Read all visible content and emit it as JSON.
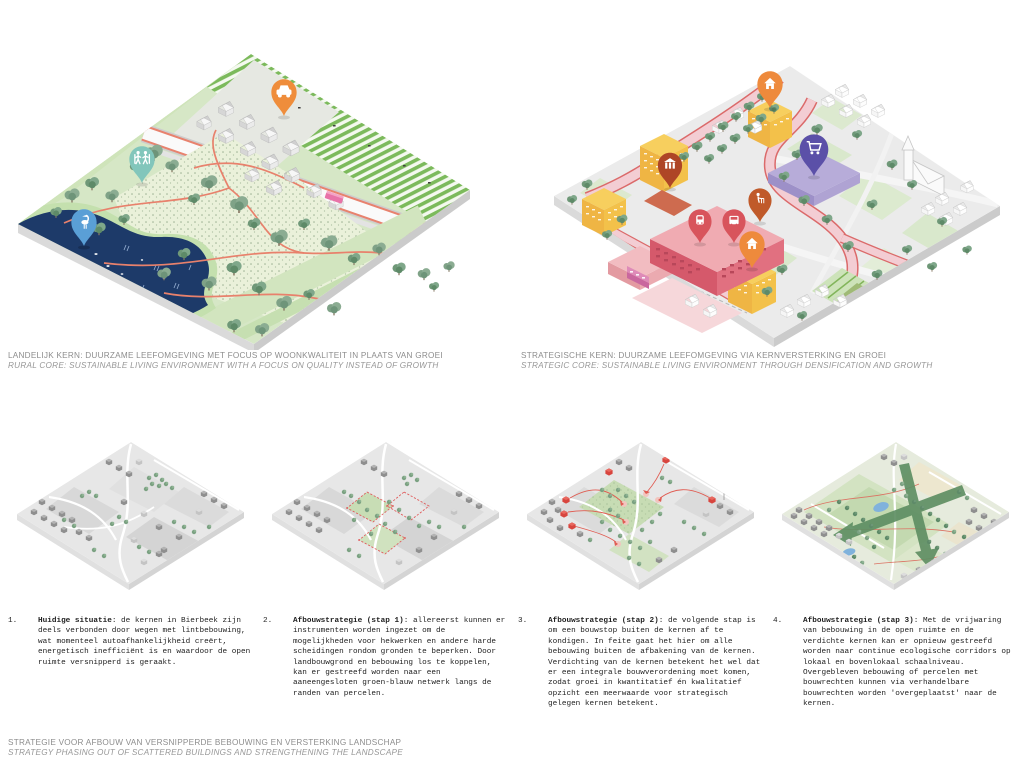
{
  "top_captions": {
    "left_line1": "LANDELIJK KERN: DUURZAME LEEFOMGEVING MET FOCUS OP WOONKWALITEIT IN PLAATS VAN GROEI",
    "left_line2": "RURAL CORE: SUSTAINABLE LIVING ENVIRONMENT WITH A FOCUS ON QUALITY INSTEAD OF GROWTH",
    "right_line1": "STRATEGISCHE KERN: DUURZAME LEEFOMGEVING VIA KERNVERSTERKING EN GROEI",
    "right_line2": "STRATEGIC CORE: SUSTAINABLE LIVING ENVIRONMENT THROUGH DENSIFICATION AND GROWTH"
  },
  "steps": [
    {
      "num": "1.",
      "title": "Huidige situatie",
      "sep": ": ",
      "body": "de kernen in Bierbeek zijn deels verbonden door wegen met lintbebouwing, wat momenteel autoafhankelijkheid creërt, energetisch inefficiënt is en waardoor de open ruimte versnipperd is geraakt."
    },
    {
      "num": "2.",
      "title": "Afbouwstrategie (stap 1)",
      "sep": ": ",
      "body": "allereerst kunnen er instrumenten worden ingezet om de mogelijkheden voor hekwerken en andere harde scheidingen rondom gronden te beperken. Door landbouwgrond en bebouwing los te koppelen, kan er gestreefd worden naar een aaneengesloten groen-blauw netwerk langs de randen van percelen."
    },
    {
      "num": "3.",
      "title": "Afbouwstrategie (stap 2)",
      "sep": ": ",
      "body": "de volgende stap is om een bouwstop buiten de kernen af te kondigen. In feite gaat het hier om alle bebouwing buiten de afbakening van de kernen. Verdichting van de kernen betekent het wel dat er een integrale bouwverordening moet komen, zodat groei in kwantitatief én kwalitatief opzicht een meerwaarde voor strategisch gelegen kernen betekent."
    },
    {
      "num": "4.",
      "title": "Afbouwstrategie (stap 3)",
      "sep": ": ",
      "body": "Met de vrijwaring van bebouwing in de open ruimte en de verdichte kernen kan er opnieuw gestreefd worden naar continue ecologische corridors op lokaal en bovenlokaal schaalniveau. Overgebleven bebouwing of percelen met bouwrechten kunnen via verhandelbare bouwrechten worden 'overgeplaatst' naar de kernen."
    }
  ],
  "footer": {
    "line1": "STRATEGIE VOOR AFBOUW VAN VERSNIPPERDE BEBOUWING EN VERSTERKING LANDSCHAP",
    "line2": "STRATEGY PHASING OUT OF SCATTERED BUILDINGS AND STRENGTHENING THE LANDSCAPE"
  },
  "pins": {
    "rural": [
      {
        "icon": "car-icon",
        "color": "#EF8D3B"
      },
      {
        "icon": "hikers-icon",
        "color": "#82C6BB"
      },
      {
        "icon": "heron-icon",
        "color": "#5A9FD6"
      }
    ],
    "strategic": [
      {
        "icon": "house-icon",
        "color": "#EE8A3C"
      },
      {
        "icon": "shopping-cart-icon",
        "color": "#5B50A8"
      },
      {
        "icon": "kiosk-icon",
        "color": "#AE4526"
      },
      {
        "icon": "train-icon",
        "color": "#D8545C"
      },
      {
        "icon": "bus-icon",
        "color": "#D8545C"
      },
      {
        "icon": "care-icon",
        "color": "#C05A2A"
      },
      {
        "icon": "house-icon",
        "color": "#EE8A3C"
      }
    ]
  },
  "palette": {
    "water": "#1D3A69",
    "meadow": "#EAF1DA",
    "field_stripe": "#7CBA5C",
    "tree": "#7FA287",
    "road_pink": "#F3CDD3",
    "bike_red": "#DB6A6A",
    "yellow_building": "#F6CB57",
    "pink_building": "#D5596B",
    "purple_building": "#B7ACD9",
    "corridor_green": "#5F8F63"
  }
}
